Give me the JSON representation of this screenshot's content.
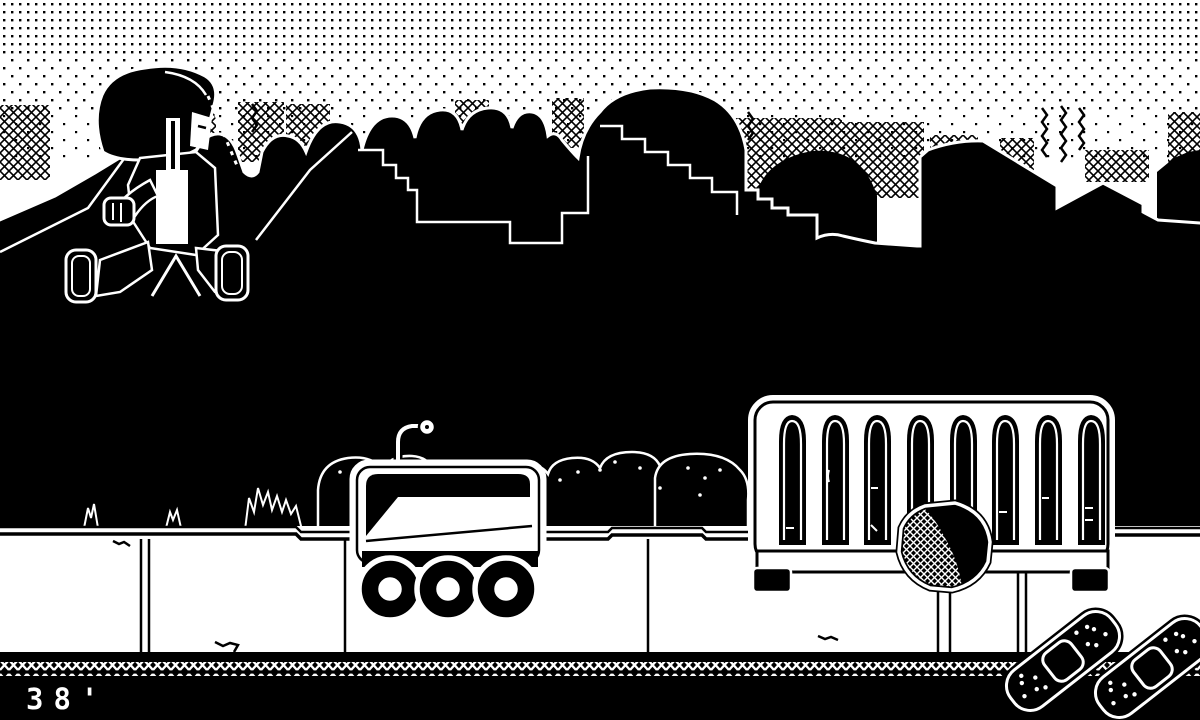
{
  "hud": {
    "distance_label": "38'"
  },
  "palette": {
    "ink": "#000000",
    "paper": "#ffffff"
  },
  "scene": {
    "objects": [
      {
        "name": "player-character",
        "glyph": "jumping-runner-sprite"
      },
      {
        "name": "delivery-robot",
        "glyph": "three-wheel-rover-with-antenna"
      },
      {
        "name": "park-gate",
        "glyph": "white-fence-with-eight-arched-slots"
      },
      {
        "name": "round-sign-on-post",
        "glyph": "dithered-octagon-sign"
      },
      {
        "name": "bandage",
        "glyph": "adhesive-bandage-x2"
      },
      {
        "name": "bushes",
        "glyph": "outlined-shrubs"
      },
      {
        "name": "grass-tufts",
        "glyph": "spiky-grass"
      },
      {
        "name": "city-skyline",
        "glyph": "rooftops-and-trees"
      },
      {
        "name": "dithered-sky",
        "glyph": "dot-gradient"
      },
      {
        "name": "sidewalk-wall",
        "glyph": "white-ledge"
      },
      {
        "name": "ground-strip",
        "glyph": "black-band-with-diamond-lattice"
      }
    ]
  }
}
